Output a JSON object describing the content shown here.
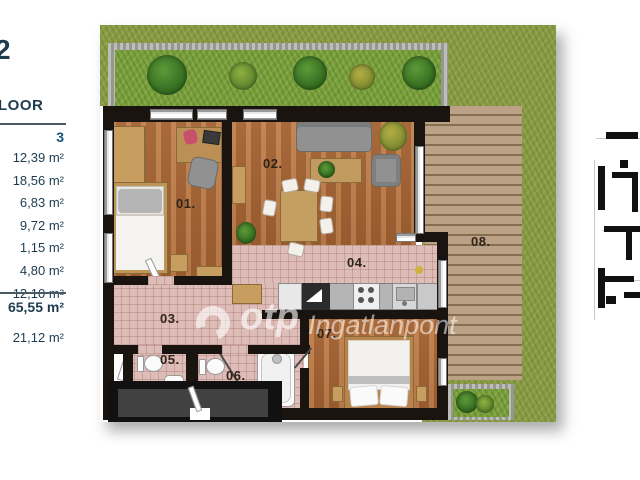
{
  "sidebar": {
    "partial_heading": "2",
    "floor_label_partial": "LOOR",
    "column_header": "3",
    "room_areas": [
      "12,39 m²",
      "18,56 m²",
      "6,83 m²",
      "9,72 m²",
      "1,15 m²",
      "4,80 m²",
      "12,10 m²"
    ],
    "total_area": "65,55 m²",
    "terrace_area": "21,12 m²"
  },
  "plan": {
    "room_labels": [
      "01.",
      "02.",
      "03.",
      "04.",
      "05.",
      "06.",
      "07.",
      "08."
    ],
    "watermark": {
      "brand": "otp",
      "suffix": "Ingatlanpont"
    },
    "colors": {
      "grass": "#8a9b45",
      "deck_wood": "#b39878",
      "floor_wood": "#b06c3a",
      "tile_pink": "#debdb8",
      "wall": "#191410",
      "sidebar_text": "#1d3c50"
    }
  }
}
